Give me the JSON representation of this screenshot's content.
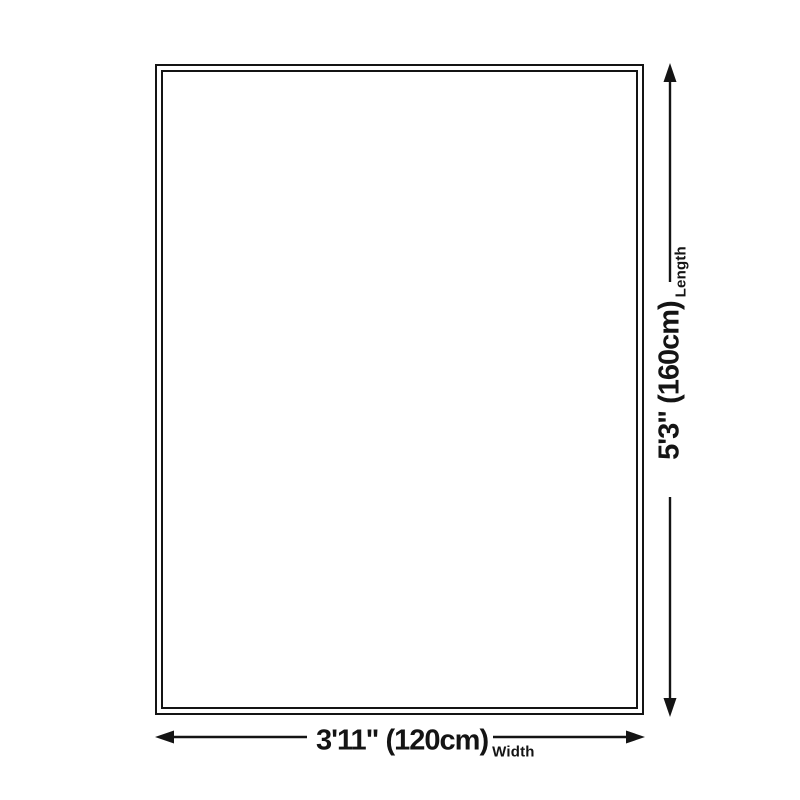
{
  "diagram": {
    "colors": {
      "ink": "#141414",
      "background": "#ffffff"
    },
    "length": {
      "value": "5'3\" (160cm)",
      "label": "Length"
    },
    "width": {
      "value": "3'11\" (120cm)",
      "label": "Width"
    }
  }
}
